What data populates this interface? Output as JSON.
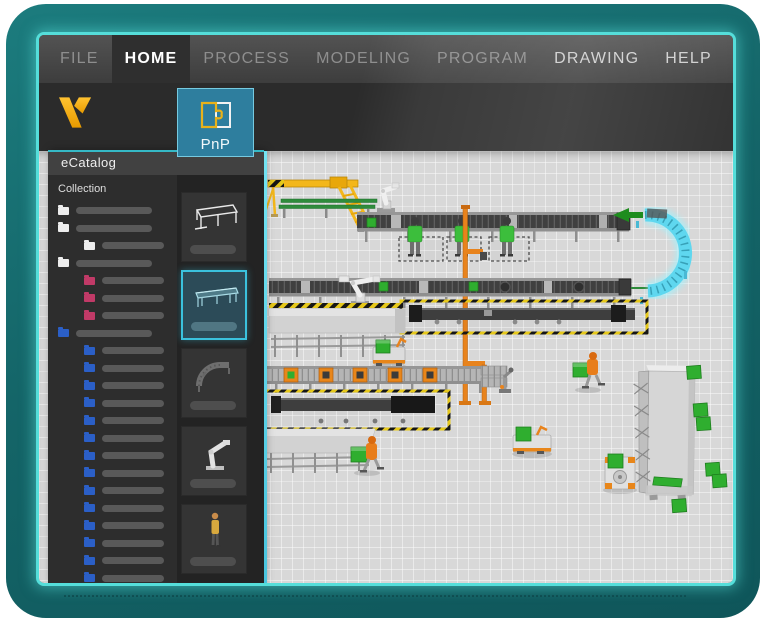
{
  "window": {
    "frame_color": "#146568",
    "frame_highlight": "#55DEDA",
    "chrome_color": "#3D3D3D"
  },
  "menu": {
    "items": [
      {
        "label": "FILE",
        "state": "dimmed"
      },
      {
        "label": "HOME",
        "state": "active"
      },
      {
        "label": "PROCESS",
        "state": "dimmed"
      },
      {
        "label": "MODELING",
        "state": "dimmed"
      },
      {
        "label": "PROGRAM",
        "state": "dimmed"
      },
      {
        "label": "DRAWING",
        "state": "normal"
      },
      {
        "label": "HELP",
        "state": "normal"
      }
    ]
  },
  "logo": {
    "icon": "v-logo",
    "color": "#F2A900"
  },
  "ribbon": {
    "pnp": {
      "label": "PnP",
      "icon": "puzzle-piece-icon",
      "background": "#2E7E9E"
    }
  },
  "ecatalog": {
    "title": "eCatalog",
    "collection_label": "Collection",
    "accent_color": "#35B9C6",
    "folder_colors": {
      "white": "#EDEDED",
      "pink": "#C13A67",
      "blue": "#2B5FC7"
    },
    "tree": [
      {
        "color": "white",
        "indent": 0
      },
      {
        "color": "white",
        "indent": 0
      },
      {
        "color": "white",
        "indent": 1
      },
      {
        "color": "white",
        "indent": 0
      },
      {
        "color": "pink",
        "indent": 1
      },
      {
        "color": "pink",
        "indent": 1
      },
      {
        "color": "pink",
        "indent": 1
      },
      {
        "color": "blue",
        "indent": 0
      },
      {
        "color": "blue",
        "indent": 1
      },
      {
        "color": "blue",
        "indent": 1
      },
      {
        "color": "blue",
        "indent": 1
      },
      {
        "color": "blue",
        "indent": 1
      },
      {
        "color": "blue",
        "indent": 1
      },
      {
        "color": "blue",
        "indent": 1
      },
      {
        "color": "blue",
        "indent": 1
      },
      {
        "color": "blue",
        "indent": 1
      },
      {
        "color": "blue",
        "indent": 1
      },
      {
        "color": "blue",
        "indent": 1
      },
      {
        "color": "blue",
        "indent": 1
      },
      {
        "color": "blue",
        "indent": 1
      },
      {
        "color": "blue",
        "indent": 1
      },
      {
        "color": "blue",
        "indent": 1
      }
    ],
    "thumbnails": [
      {
        "name": "conveyor-sketch",
        "selected": false
      },
      {
        "name": "conveyor",
        "selected": true
      },
      {
        "name": "curved-conveyor",
        "selected": false
      },
      {
        "name": "robot",
        "selected": false
      },
      {
        "name": "human",
        "selected": false
      }
    ]
  },
  "viewport": {
    "highlight_color": "#59D7EE",
    "grid_color": "#D8D8D8",
    "scene_colors": {
      "machine_yellow": "#F3B71B",
      "safety_orange": "#E8831C",
      "product_green": "#2FAE2F",
      "ghost_cyan": "#5FD7EF",
      "hazard_yellow": "#E6C81A",
      "worker_green": "#3CBE3C"
    }
  }
}
